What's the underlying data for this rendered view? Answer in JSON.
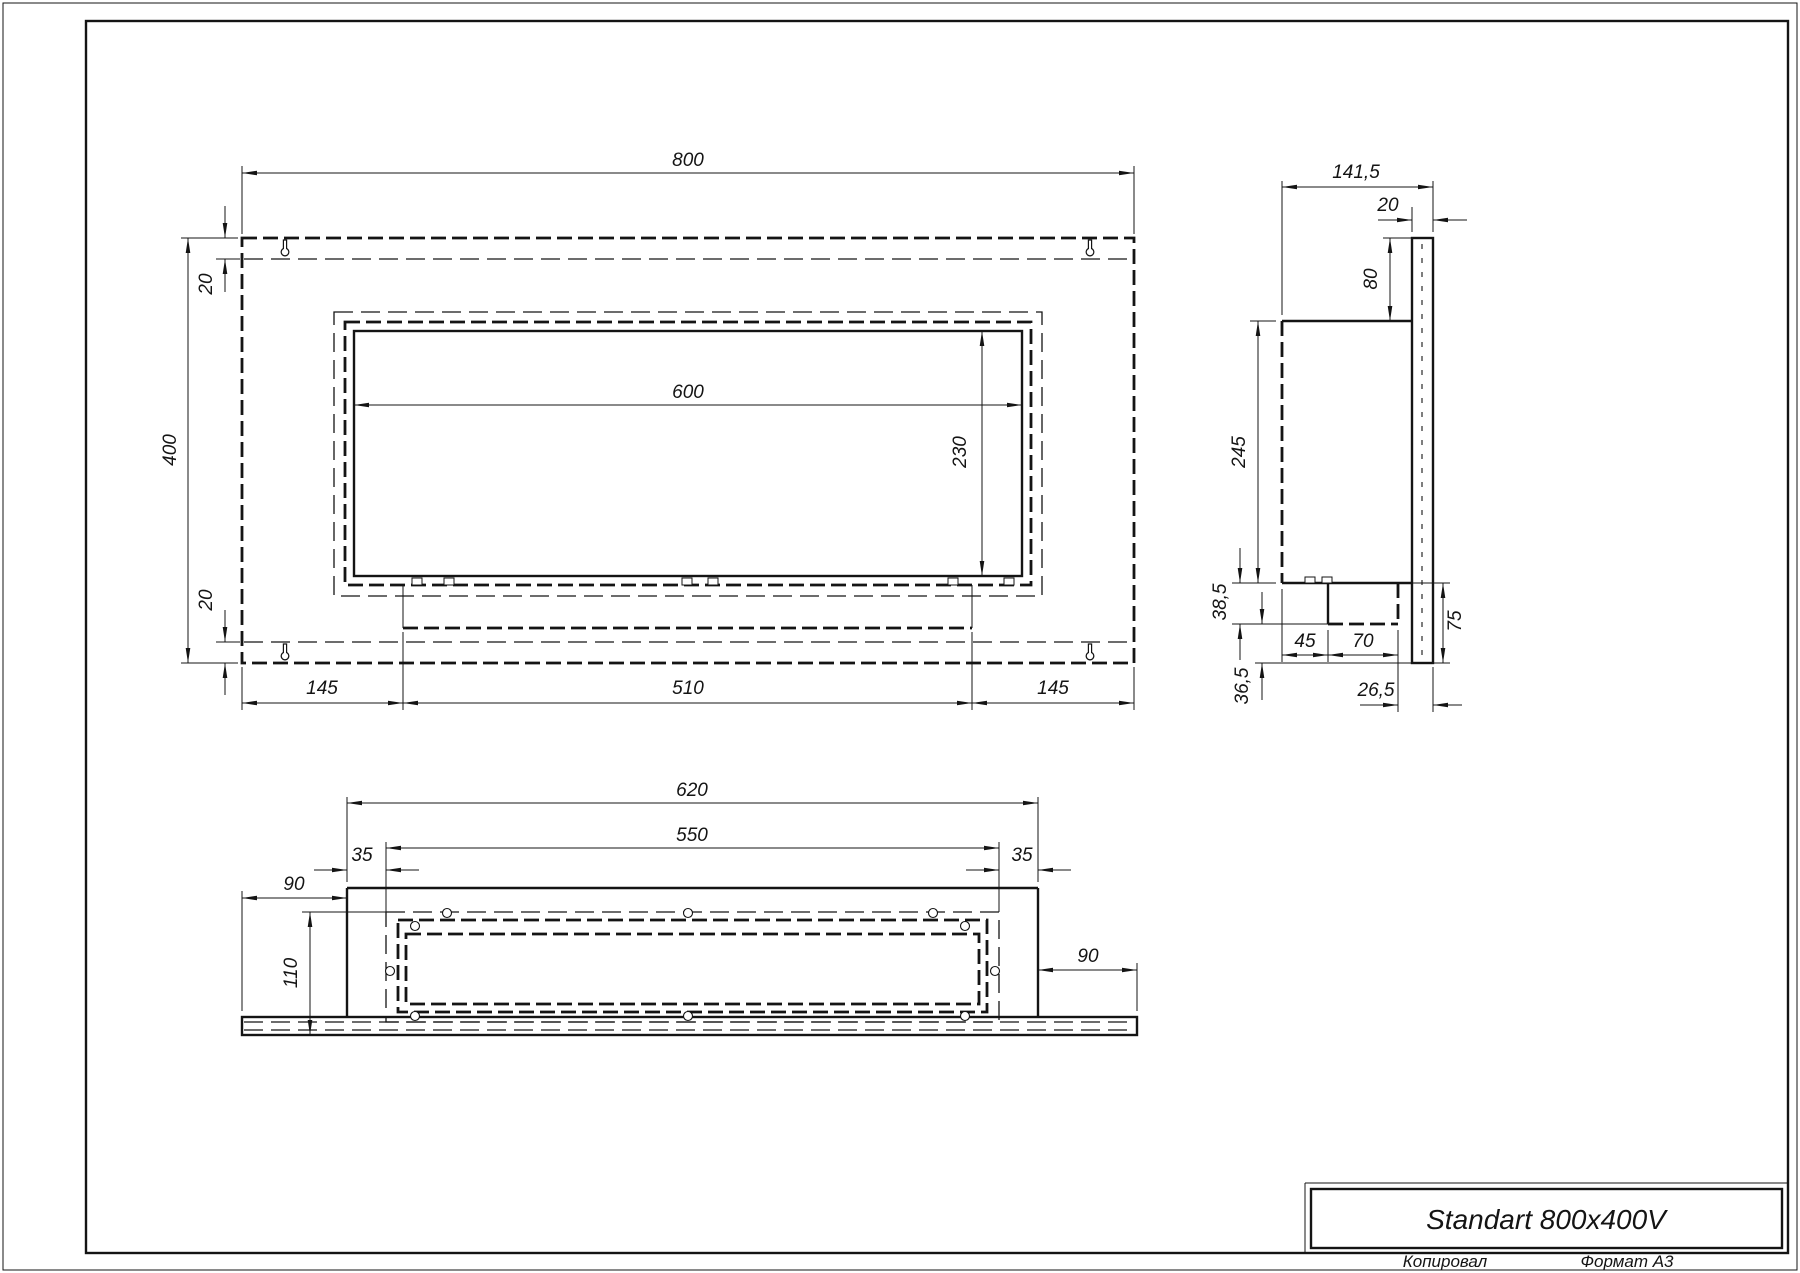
{
  "page": {
    "background": "#ffffff",
    "line_color": "#141414"
  },
  "title_block": {
    "product_name": "Standart 800x400V",
    "copied_label": "Копировал",
    "format_label": "Формат А3"
  },
  "front_view": {
    "dims": {
      "overall_width": "800",
      "overall_height": "400",
      "top_inset": "20",
      "bottom_inset": "20",
      "opening_width": "600",
      "opening_height": "230",
      "left_margin": "145",
      "tray_width": "510",
      "right_margin": "145"
    }
  },
  "side_view": {
    "dims": {
      "overall_depth": "141,5",
      "panel_thickness": "20",
      "top_offset": "80",
      "body_height": "245",
      "burner_drop": "38,5",
      "burner_offset": "45",
      "burner_depth": "70",
      "bottom_offset": "36,5",
      "back_gap": "26,5",
      "lower_panel": "75"
    }
  },
  "bottom_view": {
    "dims": {
      "box_width": "620",
      "cavity_width": "550",
      "left_inset": "35",
      "right_inset": "35",
      "left_flange": "90",
      "cavity_depth": "110",
      "right_flange": "90"
    }
  }
}
